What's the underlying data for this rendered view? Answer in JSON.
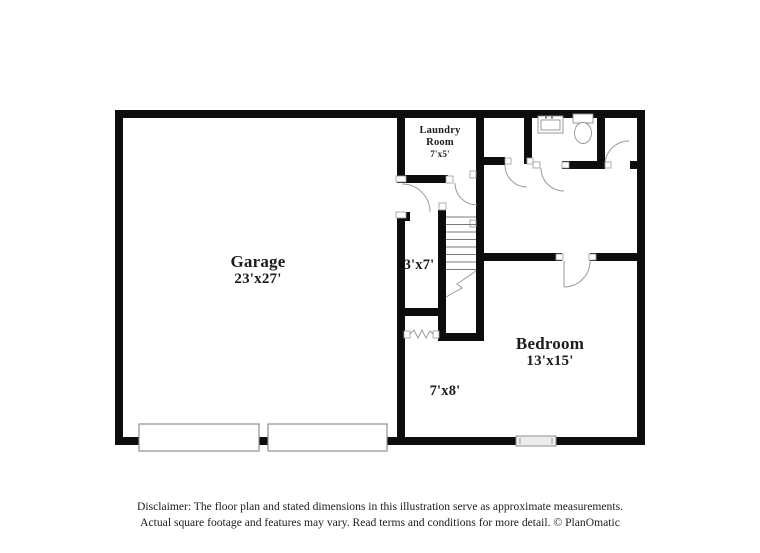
{
  "title": "Floor plan",
  "colors": {
    "background": "#ffffff",
    "wall": "#0d0d0d",
    "thin_line": "#9a9a9a",
    "stair_line": "#7a7a7a",
    "fixture": "#8f8f8f",
    "label": "#1c1c1c"
  },
  "rooms": [
    {
      "id": "garage",
      "name": "Garage",
      "dimensions": "23'x27'"
    },
    {
      "id": "laundry",
      "name": "Laundry Room",
      "dimensions": "7'x5'"
    },
    {
      "id": "hall",
      "name": "",
      "dimensions": "3'x7'"
    },
    {
      "id": "bedroom",
      "name": "Bedroom",
      "dimensions": "13'x15'"
    },
    {
      "id": "flex",
      "name": "",
      "dimensions": "7'x8'"
    }
  ],
  "fixtures": [
    {
      "name": "sink"
    },
    {
      "name": "toilet"
    },
    {
      "name": "stairs"
    },
    {
      "name": "garage-door",
      "count": 2
    },
    {
      "name": "window"
    }
  ],
  "disclaimer": {
    "line1": "Disclaimer: The floor plan and stated dimensions in this illustration serve as approximate measurements.",
    "line2": "Actual square footage and features may vary. Read terms and conditions for more detail. © PlanOmatic"
  }
}
